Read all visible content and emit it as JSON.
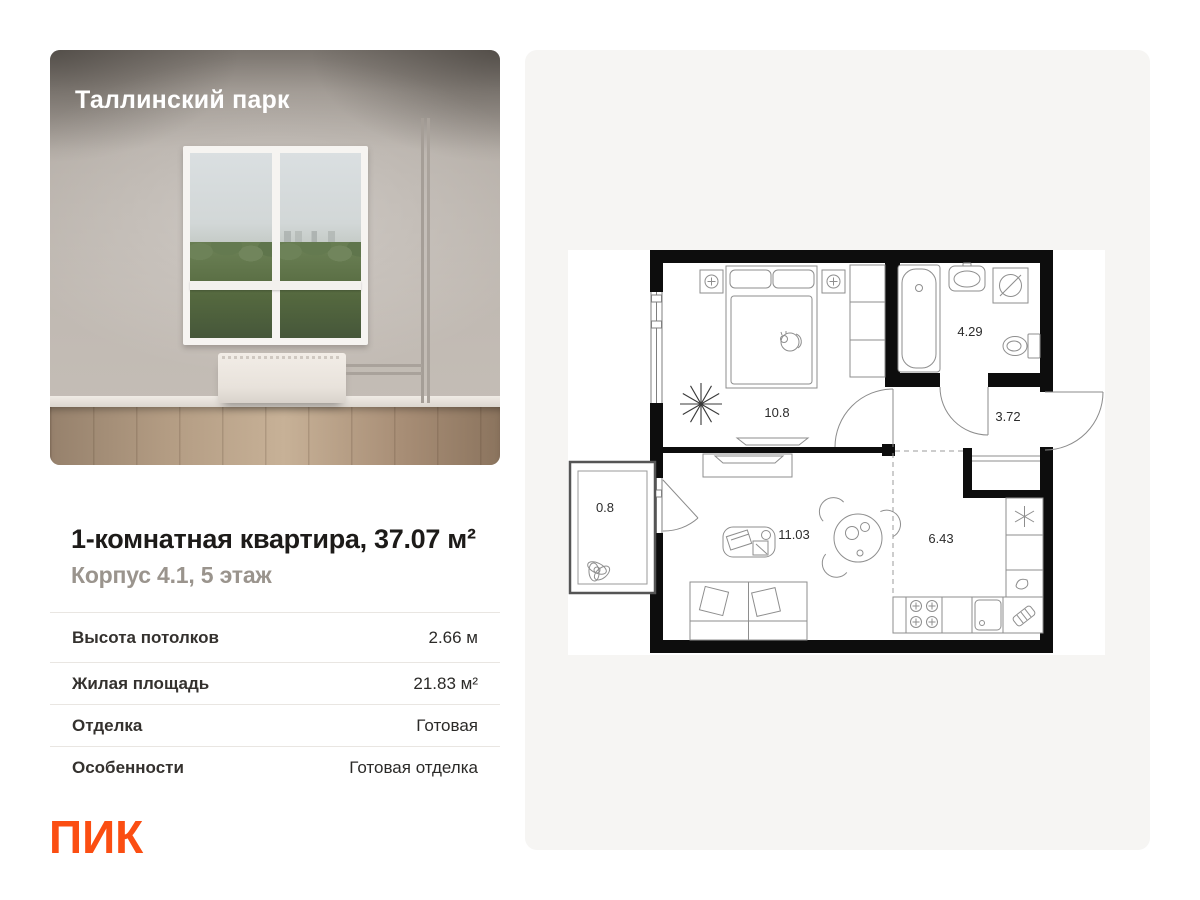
{
  "project": {
    "name": "Таллинский парк"
  },
  "listing": {
    "title": "1-комнатная квартира, 37.07 м²",
    "subtitle": "Корпус 4.1, 5 этаж",
    "specs": [
      {
        "label": "Высота потолков",
        "value": "2.66 м"
      },
      {
        "label": "Жилая площадь",
        "value": "21.83 м²"
      },
      {
        "label": "Отделка",
        "value": "Готовая"
      },
      {
        "label": "Особенности",
        "value": "Готовая отделка"
      }
    ]
  },
  "brand": {
    "logo_text": "ПИК"
  },
  "floor_plan": {
    "rooms": [
      {
        "name": "bedroom",
        "area": "10.8"
      },
      {
        "name": "bathroom",
        "area": "4.29"
      },
      {
        "name": "hallway",
        "area": "3.72"
      },
      {
        "name": "balcony",
        "area": "0.8"
      },
      {
        "name": "living-room",
        "area": "11.03"
      },
      {
        "name": "kitchen",
        "area": "6.43"
      }
    ]
  },
  "colors": {
    "brand_orange": "#FB4E12",
    "card_background": "#F6F5F3",
    "subtitle_gray": "#9A948D",
    "plan_walls": "#0D0D0D"
  }
}
